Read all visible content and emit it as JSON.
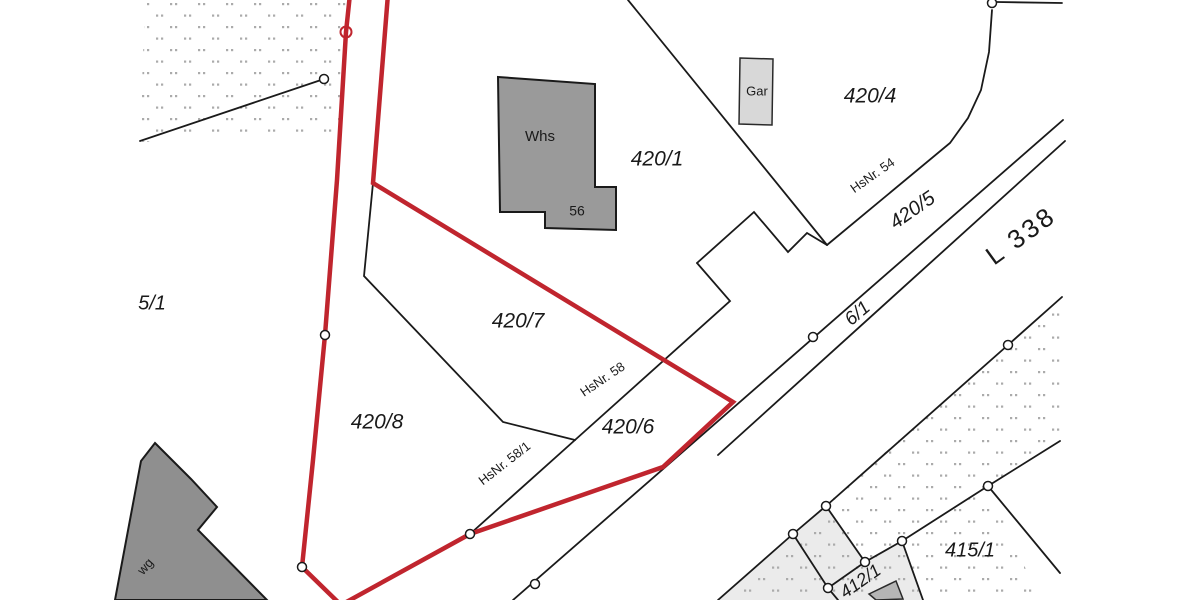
{
  "map": {
    "width": 1200,
    "height": 600,
    "background": "#ffffff",
    "colors": {
      "boundary_black": "#1a1a1a",
      "highlight_red": "#c0252e",
      "dot_pattern": "#ababab",
      "building_dark_gray": "#8f8f8f",
      "building_gray": "#9a9a9a",
      "building_light_gray": "#d8d8d8",
      "building_mid_gray": "#b5b5b5",
      "parcel_light_gray": "#ebebeb",
      "text": "#1a1a1a"
    },
    "labels": [
      {
        "name": "building-label-whs",
        "text": "Whs",
        "x": 540,
        "y": 137,
        "rot": 0,
        "size": 15,
        "italic": false,
        "spacing": 0
      },
      {
        "name": "house-number-56",
        "text": "56",
        "x": 577,
        "y": 212,
        "rot": 0,
        "size": 14,
        "italic": false,
        "spacing": 0
      },
      {
        "name": "parcel-420-1",
        "text": "420/1",
        "x": 657,
        "y": 160,
        "rot": 0,
        "size": 21,
        "italic": true,
        "spacing": 0
      },
      {
        "name": "building-label-gar",
        "text": "Gar",
        "x": 757,
        "y": 92,
        "rot": 0,
        "size": 13,
        "italic": false,
        "spacing": 0
      },
      {
        "name": "parcel-420-4",
        "text": "420/4",
        "x": 870,
        "y": 97,
        "rot": 0,
        "size": 21,
        "italic": true,
        "spacing": 0
      },
      {
        "name": "house-number-54",
        "text": "HsNr. 54",
        "x": 873,
        "y": 176,
        "rot": -35,
        "size": 13,
        "italic": false,
        "spacing": 0
      },
      {
        "name": "parcel-420-5",
        "text": "420/5",
        "x": 913,
        "y": 211,
        "rot": -35,
        "size": 20,
        "italic": true,
        "spacing": 0
      },
      {
        "name": "road-name-l338",
        "text": "L 338",
        "x": 1022,
        "y": 237,
        "rot": -36,
        "size": 26,
        "italic": false,
        "spacing": 3
      },
      {
        "name": "parcel-6-1",
        "text": "6/1",
        "x": 858,
        "y": 314,
        "rot": -40,
        "size": 19,
        "italic": true,
        "spacing": 0
      },
      {
        "name": "parcel-420-7",
        "text": "420/7",
        "x": 518,
        "y": 322,
        "rot": 0,
        "size": 21,
        "italic": true,
        "spacing": 0
      },
      {
        "name": "house-number-58",
        "text": "HsNr. 58",
        "x": 603,
        "y": 380,
        "rot": -34,
        "size": 13,
        "italic": false,
        "spacing": 0
      },
      {
        "name": "parcel-420-6",
        "text": "420/6",
        "x": 628,
        "y": 428,
        "rot": 0,
        "size": 21,
        "italic": true,
        "spacing": 0
      },
      {
        "name": "house-number-58-1",
        "text": "HsNr. 58/1",
        "x": 505,
        "y": 464,
        "rot": -38,
        "size": 13,
        "italic": false,
        "spacing": 0
      },
      {
        "name": "parcel-420-8",
        "text": "420/8",
        "x": 377,
        "y": 423,
        "rot": 0,
        "size": 21,
        "italic": true,
        "spacing": 0
      },
      {
        "name": "parcel-5-1",
        "text": "5/1",
        "x": 152,
        "y": 304,
        "rot": 0,
        "size": 20,
        "italic": true,
        "spacing": 0
      },
      {
        "name": "parcel-415-1",
        "text": "415/1",
        "x": 970,
        "y": 551,
        "rot": 0,
        "size": 20,
        "italic": true,
        "spacing": 0
      },
      {
        "name": "parcel-412-1",
        "text": "412/1",
        "x": 861,
        "y": 582,
        "rot": -35,
        "size": 18,
        "italic": true,
        "spacing": 0
      },
      {
        "name": "street-fragment-wg",
        "text": "wg",
        "x": 146,
        "y": 567,
        "rot": -48,
        "size": 13,
        "italic": false,
        "spacing": 0
      }
    ],
    "red_boundary": {
      "name": "highlighted-parcel-outline",
      "points": "350,-6 346,32 337,180 325,335 313,460 302,567 341,605 470,534 663,467 733,402 373,183 388,-6",
      "color": "#c0252e",
      "width": 4.5
    },
    "black_lines": [
      {
        "name": "grassland-boundary",
        "points": "140,141 324,79"
      },
      {
        "name": "boundary-420-1-420-4",
        "points": "628,0 827,245"
      },
      {
        "name": "boundary-zigzag-road",
        "points": "697,263 754,212 788,252 807,233 827,245"
      },
      {
        "name": "boundary-420-6-front",
        "points": "697,263 730,301 575,440"
      },
      {
        "name": "boundary-420-7-420-8",
        "points": "575,440 503,422 364,276 373,183"
      },
      {
        "name": "boundary-hsnr-58-1",
        "points": "575,440 470,534"
      },
      {
        "name": "boundary-420-4-south",
        "points": "827,245 950,143 968,118 981,90 989,52 992,10"
      },
      {
        "name": "boundary-top-right",
        "points": "997,2 1062,3"
      },
      {
        "name": "road-edge-upper",
        "points": "1063,120 513,600"
      },
      {
        "name": "road-edge-path-6-1",
        "points": "1065,141 718,455"
      },
      {
        "name": "road-edge-lower",
        "points": "1062,297 1008,345 826,506 793,534 718,600"
      },
      {
        "name": "boundary-412-1-cap",
        "points": "826,506 865,562"
      },
      {
        "name": "boundary-415-1-north",
        "points": "988,486 902,541 865,562 828,588"
      },
      {
        "name": "boundary-412-1-west",
        "points": "793,534 828,588 838,600"
      },
      {
        "name": "boundary-412-1-east",
        "points": "902,541 923,600"
      },
      {
        "name": "boundary-415-1-southeast",
        "points": "988,486 1060,573"
      },
      {
        "name": "boundary-415-1-northeast",
        "points": "988,486 1060,441"
      }
    ],
    "areas": [
      {
        "name": "parcel-412-1-area",
        "points": "793,534 825,505 865,562 902,541 923,600 718,600",
        "fill": "#ebebeb"
      }
    ],
    "dot_regions": [
      {
        "name": "grassland-dots-northwest",
        "points": "145,0 349,0 339,135 140,142"
      },
      {
        "name": "grassland-dots-southeast",
        "points": "1062,296 718,600 1040,600 988,486 1060,441"
      }
    ],
    "buildings": [
      {
        "name": "building-whs-56",
        "points": "498,77 595,84 595,187 616,187 616,230 545,228 545,212 500,212",
        "fill": "#9a9a9a",
        "stroke": "#1a1a1a",
        "sw": 2
      },
      {
        "name": "building-garage",
        "points": "740,58 773,59 772,125 739,124",
        "fill": "#d8d8d8",
        "stroke": "#2a2a2a",
        "sw": 1.5
      },
      {
        "name": "building-southwest",
        "points": "155,443 191,479 217,507 198,530 267,600 115,600 141,461",
        "fill": "#8f8f8f",
        "stroke": "#1a1a1a",
        "sw": 2
      },
      {
        "name": "building-412-1-small",
        "points": "869,594 896,581 903,599 876,600",
        "fill": "#b5b5b5",
        "stroke": "#2a2a2a",
        "sw": 1.5
      }
    ],
    "markers": {
      "white_circles": [
        [
          324,
          79
        ],
        [
          992,
          3
        ],
        [
          813,
          337
        ],
        [
          535,
          584
        ],
        [
          1008,
          345
        ],
        [
          826,
          506
        ],
        [
          793,
          534
        ],
        [
          865,
          562
        ],
        [
          902,
          541
        ],
        [
          988,
          486
        ],
        [
          828,
          588
        ],
        [
          325,
          335
        ],
        [
          302,
          567
        ],
        [
          470,
          534
        ]
      ],
      "white_circle_radius": 4.5,
      "red_circles": [
        [
          346,
          32
        ]
      ],
      "red_circle_radius": 5.5
    }
  }
}
